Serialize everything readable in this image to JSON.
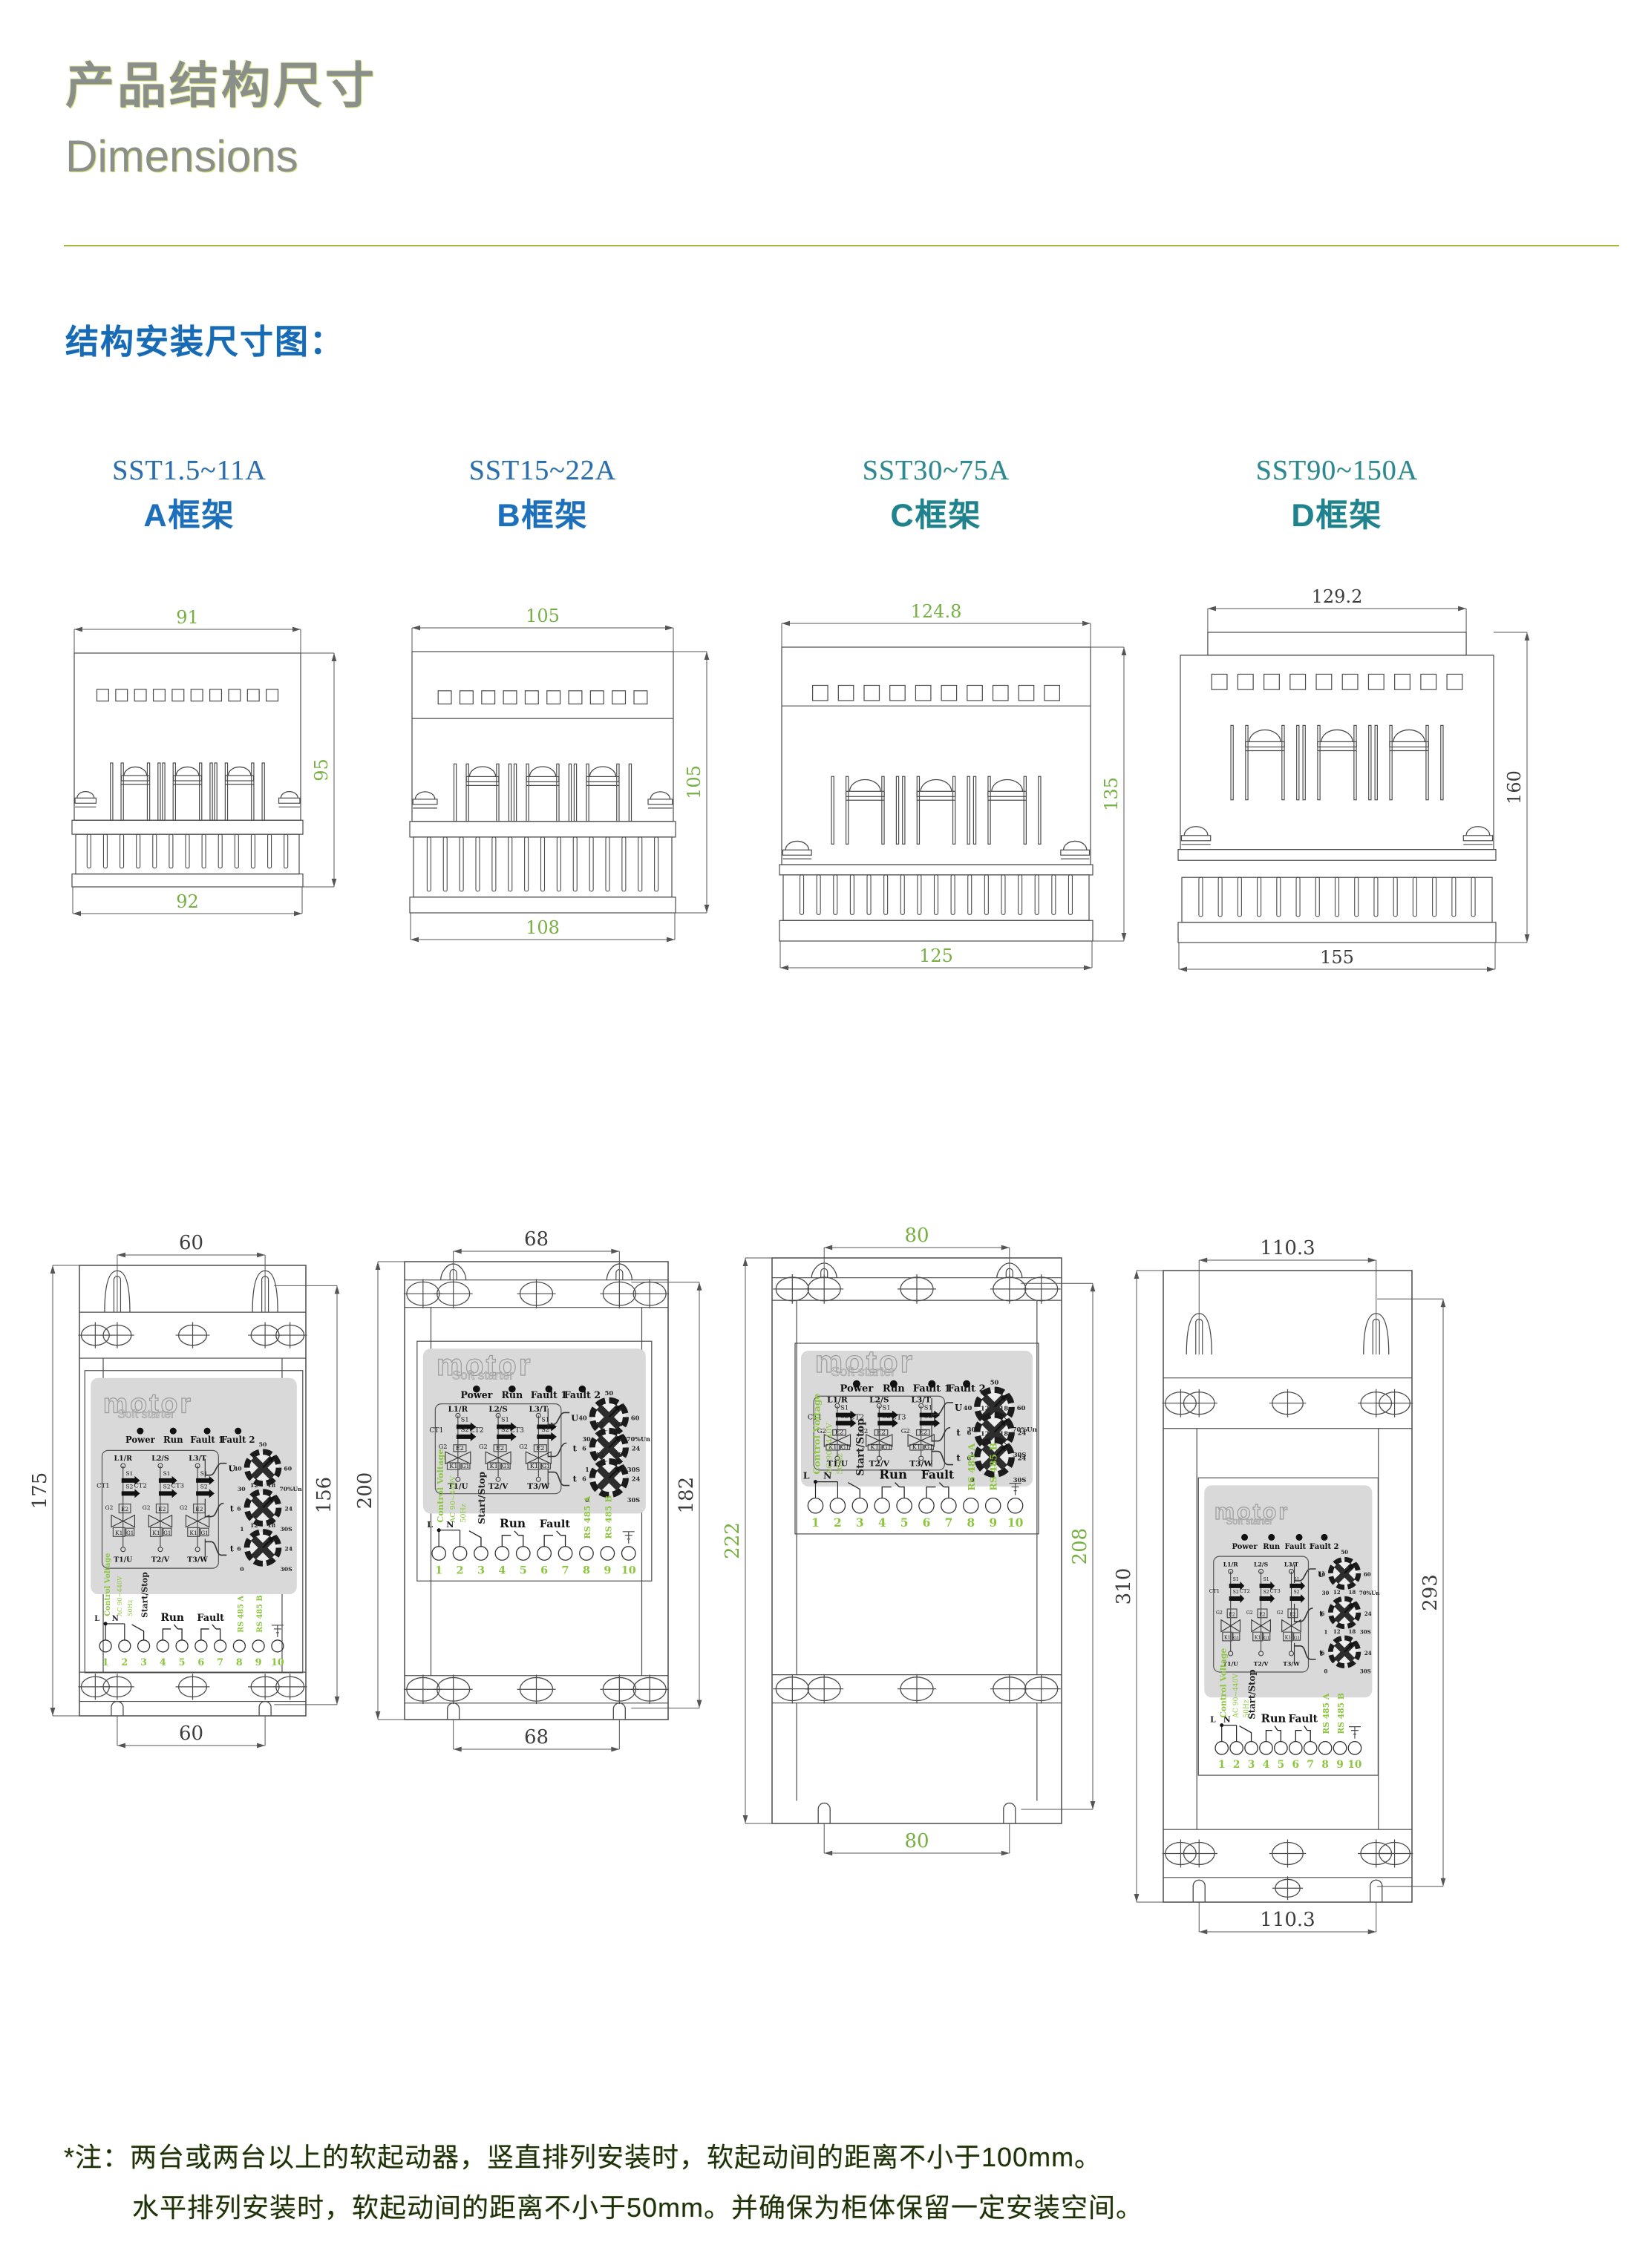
{
  "page": {
    "title_zh": "产品结构尺寸",
    "title_en": "Dimensions",
    "section_heading": "结构安装尺寸图：",
    "note_line1": "*注：两台或两台以上的软起动器，竖直排列安装时，软起动间的距离不小于100mm。",
    "note_line2": "水平排列安装时，软起动间的距离不小于50mm。并确保为柜体保留一定安装空间。"
  },
  "colors": {
    "title_gray": "#8b8f8b",
    "divider_olive": "#a9b83c",
    "heading_blue": "#176bb5",
    "model_blue": "#2b6cb3",
    "model_teal": "#2e8796",
    "dim_green": "#76b043",
    "dim_dark": "#3d3d3d",
    "line_gray": "#4b4b4b",
    "panel_gray": "#d9d9d9",
    "terminal_green": "#8cc63f",
    "note_ink": "#20300f"
  },
  "frames": [
    {
      "id": "A",
      "model": "SST1.5~11A",
      "frame_label": "A框架",
      "label_color": "blue",
      "top_view": {
        "top_width": "91",
        "side_height": "95",
        "bottom_width": "92",
        "dim_color": "green"
      },
      "mount_view": {
        "hole_span_top": "60",
        "overall_height": "175",
        "mount_height": "156",
        "hole_span_bottom": "60",
        "dim_color": "dark"
      }
    },
    {
      "id": "B",
      "model": "SST15~22A",
      "frame_label": "B框架",
      "label_color": "blue",
      "top_view": {
        "top_width": "105",
        "side_height": "105",
        "bottom_width": "108",
        "dim_color": "green"
      },
      "mount_view": {
        "hole_span_top": "68",
        "overall_height": "200",
        "mount_height": "182",
        "hole_span_bottom": "68",
        "dim_color": "dark"
      }
    },
    {
      "id": "C",
      "model": "SST30~75A",
      "frame_label": "C框架",
      "label_color": "teal",
      "top_view": {
        "top_width": "124.8",
        "side_height": "135",
        "bottom_width": "125",
        "dim_color": "green"
      },
      "mount_view": {
        "hole_span_top": "80",
        "overall_height": "222",
        "mount_height": "208",
        "hole_span_bottom": "80",
        "dim_color": "green"
      }
    },
    {
      "id": "D",
      "model": "SST90~150A",
      "frame_label": "D框架",
      "label_color": "teal",
      "top_view": {
        "top_width": "129.2",
        "side_height": "160",
        "bottom_width": "155",
        "dim_color": "dark"
      },
      "mount_view": {
        "hole_span_top": "110.3",
        "overall_height": "310",
        "mount_height": "293",
        "hole_span_bottom": "110.3",
        "dim_color": "dark"
      }
    }
  ],
  "panel": {
    "logo_main": "motor",
    "logo_sub": "Soft starter",
    "leds": [
      "Power",
      "Run",
      "Fault 1",
      "Fault 2"
    ],
    "circuit": {
      "inputs": [
        "L1/R",
        "L2/S",
        "L3/T"
      ],
      "outputs": [
        "T1/U",
        "T2/V",
        "T3/W"
      ],
      "ct": [
        "CT1",
        "CT2",
        "CT3"
      ],
      "switches": [
        "S1",
        "S2"
      ],
      "scr": [
        "G2",
        "E2",
        "K1",
        "G1"
      ]
    },
    "knobs": [
      {
        "name": "initial-voltage-knob",
        "icon_label": "U",
        "ticks": [
          "30",
          "40",
          "50",
          "60",
          "70%Un"
        ]
      },
      {
        "name": "ramp-up-time-knob",
        "icon_label": "t",
        "ticks": [
          "1",
          "6",
          "12",
          "18",
          "24",
          "30S"
        ]
      },
      {
        "name": "ramp-down-time-knob",
        "icon_label": "t",
        "ticks": [
          "0",
          "6",
          "12",
          "18",
          "24",
          "30S"
        ]
      }
    ],
    "terminals": {
      "numbers": [
        "1",
        "2",
        "3",
        "4",
        "5",
        "6",
        "7",
        "8",
        "9",
        "10"
      ],
      "ln": [
        "L",
        "N"
      ],
      "control_voltage": [
        "Control Voltage",
        "AC 90~440V",
        "50Hz"
      ],
      "start_stop": "Start/Stop",
      "run": "Run",
      "fault": "Fault",
      "rs485a": "RS 485 A",
      "rs485b": "RS 485 B"
    }
  }
}
